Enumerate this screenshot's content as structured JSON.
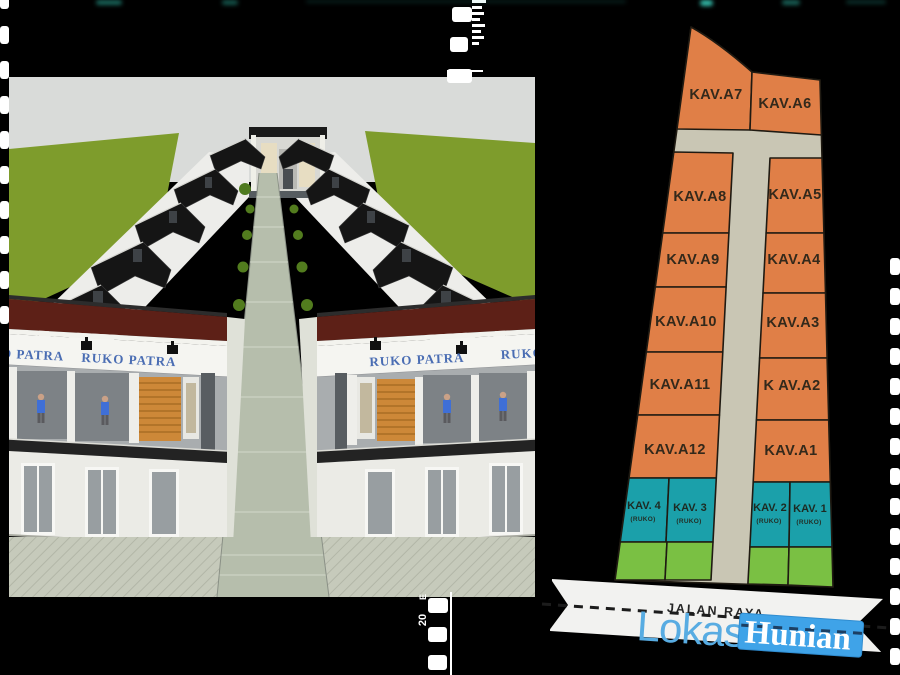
{
  "film": {
    "frame_number": "20",
    "edge_code": "E"
  },
  "photo": {
    "signs": {
      "left_partial": "RUKO PATRA",
      "left": "RUKO PATRA",
      "right": "RUKO PATRA",
      "right_partial": "RUKO PATRA"
    }
  },
  "site_plan": {
    "road_label": "JALAN RAYA",
    "colors": {
      "plot_orange": "#E07F47",
      "ruko_teal": "#1BA0AA",
      "garden_green": "#7AC043",
      "road_beige": "#C9C6B4",
      "outline": "#1F1A12"
    },
    "plots": {
      "a1": "KAV.A1",
      "a2": "K AV.A2",
      "a3": "KAV.A3",
      "a4": "KAV.A4",
      "a5": "KAV.A5",
      "a6": "KAV.A6",
      "a7": "KAV.A7",
      "a8": "KAV.A8",
      "a9": "KAV.A9",
      "a10": "KAV.A10",
      "a11": "KAV.A11",
      "a12": "KAV.A12"
    },
    "ruko": {
      "r1": {
        "label": "KAV. 1",
        "sub": "(RUKO)"
      },
      "r2": {
        "label": "KAV. 2",
        "sub": "(RUKO)"
      },
      "r3": {
        "label": "KAV. 3",
        "sub": "(RUKO)"
      },
      "r4": {
        "label": "KAV. 4",
        "sub": "(RUKO)"
      }
    }
  },
  "branding": {
    "location_word": "Lokasi",
    "housing_word": "Hunian",
    "highlight_color": "#3FA3E8",
    "location_color": "#58ACE2"
  }
}
